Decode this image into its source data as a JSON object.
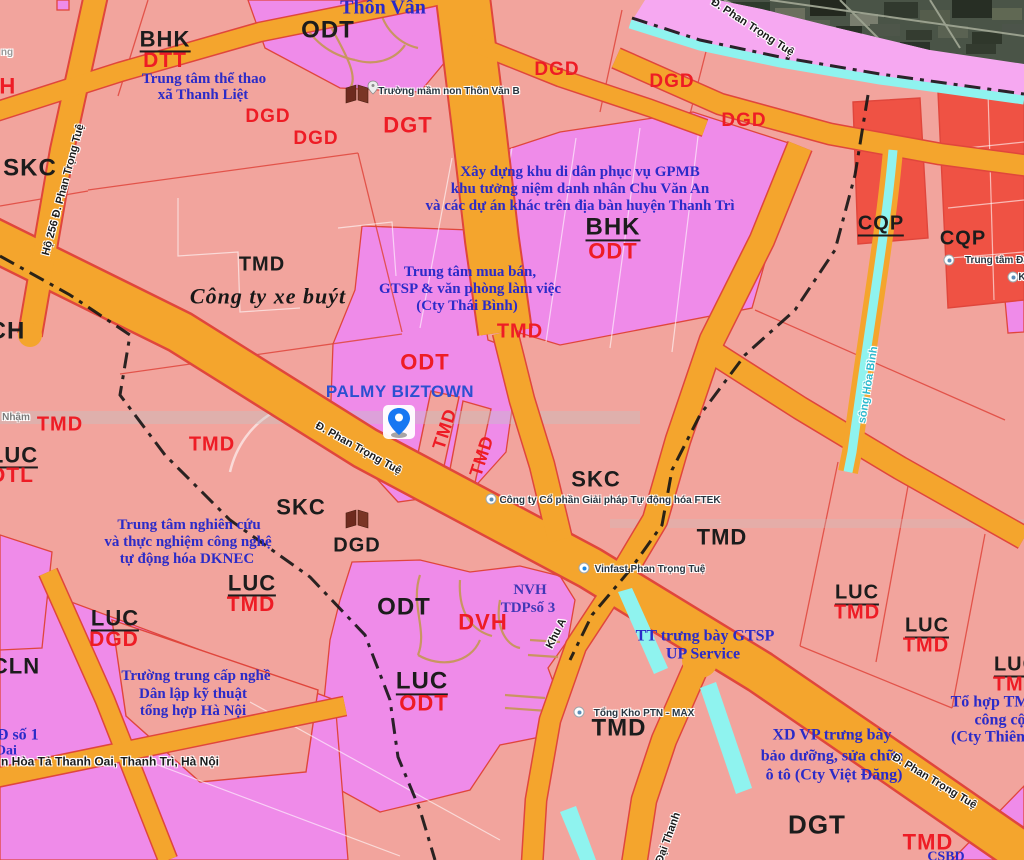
{
  "map": {
    "colors": {
      "salmon": "#F2A49D",
      "pink": "#EF8BE9",
      "pink-light": "#F6A8F1",
      "orange": "#F4A52D",
      "red-line": "#E0463C",
      "red-zone": "#EF5244",
      "cyan": "#8FF3EF",
      "label-red": "#EE1C25",
      "label-black": "#1C1C1C",
      "label-blue": "#2B2BC8",
      "palmy-blue": "#2B50D0",
      "nvh-blue": "#4038B6"
    },
    "zone_codes": [
      {
        "t": "BHK",
        "c": "black",
        "x": 165,
        "y": 40,
        "s": 22,
        "u": 1
      },
      {
        "t": "DTT",
        "c": "red",
        "x": 165,
        "y": 61,
        "s": 21
      },
      {
        "t": "ODT",
        "c": "black",
        "x": 328,
        "y": 30,
        "s": 24
      },
      {
        "t": "DGD",
        "c": "red",
        "x": 268,
        "y": 117,
        "s": 19
      },
      {
        "t": "DGD",
        "c": "red",
        "x": 316,
        "y": 139,
        "s": 19
      },
      {
        "t": "DGD",
        "c": "red",
        "x": 557,
        "y": 70,
        "s": 19
      },
      {
        "t": "DGD",
        "c": "red",
        "x": 672,
        "y": 82,
        "s": 19
      },
      {
        "t": "DGD",
        "c": "red",
        "x": 744,
        "y": 121,
        "s": 19
      },
      {
        "t": "DGT",
        "c": "red",
        "x": 408,
        "y": 125,
        "s": 22
      },
      {
        "t": "SKC",
        "c": "black",
        "x": 30,
        "y": 168,
        "s": 24
      },
      {
        "t": "VH",
        "c": "red",
        "x": 0,
        "y": 86,
        "s": 22
      },
      {
        "t": "CH",
        "c": "black",
        "x": 7,
        "y": 331,
        "s": 24
      },
      {
        "t": "BHK",
        "c": "black",
        "x": 613,
        "y": 228,
        "s": 24,
        "u": 1
      },
      {
        "t": "ODT",
        "c": "red",
        "x": 613,
        "y": 251,
        "s": 22
      },
      {
        "t": "TMD",
        "c": "red",
        "x": 520,
        "y": 332,
        "s": 20
      },
      {
        "t": "TMD",
        "c": "black",
        "x": 262,
        "y": 265,
        "s": 20
      },
      {
        "t": "ODT",
        "c": "red",
        "x": 425,
        "y": 362,
        "s": 22
      },
      {
        "t": "TMD",
        "c": "red",
        "x": 445,
        "y": 429,
        "s": 18,
        "rot": -72
      },
      {
        "t": "TMD",
        "c": "red",
        "x": 482,
        "y": 456,
        "s": 18,
        "rot": -72
      },
      {
        "t": "SKC",
        "c": "black",
        "x": 596,
        "y": 479,
        "s": 22
      },
      {
        "t": "TMD",
        "c": "black",
        "x": 722,
        "y": 537,
        "s": 22
      },
      {
        "t": "CQP",
        "c": "black",
        "x": 881,
        "y": 225,
        "s": 20,
        "u": 1
      },
      {
        "t": "CQP",
        "c": "black",
        "x": 963,
        "y": 239,
        "s": 20
      },
      {
        "t": "TMD",
        "c": "red",
        "x": 60,
        "y": 425,
        "s": 20
      },
      {
        "t": "TMD",
        "c": "red",
        "x": 212,
        "y": 445,
        "s": 20
      },
      {
        "t": "LUC",
        "c": "black",
        "x": 14,
        "y": 456,
        "s": 22,
        "u": 1
      },
      {
        "t": "DTL",
        "c": "red",
        "x": 12,
        "y": 476,
        "s": 21
      },
      {
        "t": "SKC",
        "c": "black",
        "x": 301,
        "y": 507,
        "s": 22
      },
      {
        "t": "DGD",
        "c": "black",
        "x": 357,
        "y": 546,
        "s": 20
      },
      {
        "t": "LUC",
        "c": "black",
        "x": 252,
        "y": 584,
        "s": 22,
        "u": 1
      },
      {
        "t": "TMD",
        "c": "red",
        "x": 251,
        "y": 605,
        "s": 21
      },
      {
        "t": "LUC",
        "c": "black",
        "x": 115,
        "y": 619,
        "s": 22,
        "u": 1
      },
      {
        "t": "DGD",
        "c": "red",
        "x": 114,
        "y": 640,
        "s": 21
      },
      {
        "t": "CLN",
        "c": "black",
        "x": 16,
        "y": 666,
        "s": 22
      },
      {
        "t": "ODT",
        "c": "black",
        "x": 404,
        "y": 607,
        "s": 24
      },
      {
        "t": "DVH",
        "c": "red",
        "x": 483,
        "y": 622,
        "s": 22
      },
      {
        "t": "LUC",
        "c": "black",
        "x": 422,
        "y": 682,
        "s": 24,
        "u": 1
      },
      {
        "t": "ODT",
        "c": "red",
        "x": 424,
        "y": 703,
        "s": 22
      },
      {
        "t": "TMD",
        "c": "black",
        "x": 619,
        "y": 728,
        "s": 24
      },
      {
        "t": "LUC",
        "c": "black",
        "x": 857,
        "y": 594,
        "s": 20,
        "u": 1
      },
      {
        "t": "TMD",
        "c": "red",
        "x": 857,
        "y": 613,
        "s": 20
      },
      {
        "t": "LUC",
        "c": "black",
        "x": 927,
        "y": 627,
        "s": 20,
        "u": 1
      },
      {
        "t": "TMD",
        "c": "red",
        "x": 926,
        "y": 646,
        "s": 20
      },
      {
        "t": "LUC",
        "c": "black",
        "x": 1016,
        "y": 666,
        "s": 20,
        "u": 1
      },
      {
        "t": "TMD",
        "c": "red",
        "x": 1016,
        "y": 685,
        "s": 20
      },
      {
        "t": "DGT",
        "c": "black",
        "x": 817,
        "y": 825,
        "s": 26
      },
      {
        "t": "TMD",
        "c": "red",
        "x": 928,
        "y": 842,
        "s": 22
      }
    ],
    "place_texts": [
      {
        "t": "Trung tâm thể thao",
        "x": 204,
        "y": 80
      },
      {
        "t": "xã Thanh Liệt",
        "x": 203,
        "y": 96
      },
      {
        "t": "Thôn Vân",
        "x": 383,
        "y": 8,
        "s": 20
      },
      {
        "t": "Xây dựng khu di dân phục vụ GPMB",
        "x": 580,
        "y": 173
      },
      {
        "t": "khu tưởng niệm danh nhân Chu Văn An",
        "x": 580,
        "y": 190
      },
      {
        "t": "và các dự án khác trên địa bàn huyện Thanh Trì",
        "x": 580,
        "y": 207
      },
      {
        "t": "Trung tâm mua bán,",
        "x": 470,
        "y": 273
      },
      {
        "t": "GTSP & văn phòng làm việc",
        "x": 470,
        "y": 290
      },
      {
        "t": "(Cty Thái Bình)",
        "x": 467,
        "y": 307
      },
      {
        "t": "Trung tâm nghiên cứu",
        "x": 189,
        "y": 526
      },
      {
        "t": "và thực nghiệm công nghệ",
        "x": 188,
        "y": 543
      },
      {
        "t": "tự động hóa DKNEC",
        "x": 187,
        "y": 560
      },
      {
        "t": "Trường trung cấp nghề",
        "x": 196,
        "y": 677
      },
      {
        "t": "Dân lập kỹ thuật",
        "x": 193,
        "y": 695
      },
      {
        "t": "tổng hợp Hà Nội",
        "x": 193,
        "y": 712
      },
      {
        "t": "TT trưng bày GTSP",
        "x": 705,
        "y": 637,
        "s": 16
      },
      {
        "t": "UP Service",
        "x": 703,
        "y": 655,
        "s": 16
      },
      {
        "t": "XD VP trưng bày",
        "x": 832,
        "y": 736,
        "s": 16
      },
      {
        "t": "bảo dưỡng, sửa chữa",
        "x": 832,
        "y": 757,
        "s": 16
      },
      {
        "t": "ô tô (Cty Việt Đăng)",
        "x": 834,
        "y": 776,
        "s": 16
      },
      {
        "t": "Tổ hợp TM",
        "x": 990,
        "y": 703,
        "s": 16
      },
      {
        "t": "công cộ",
        "x": 1000,
        "y": 721,
        "s": 16
      },
      {
        "t": "(Cty Thiên",
        "x": 988,
        "y": 738,
        "s": 16
      },
      {
        "t": "NVH",
        "x": 530,
        "y": 591,
        "c": "#4038B6"
      },
      {
        "t": "TDPsố 3",
        "x": 528,
        "y": 609,
        "c": "#4038B6"
      },
      {
        "t": "ĐĐ số 1",
        "x": 12,
        "y": 736,
        "s": 16
      },
      {
        "t": "Oai",
        "x": 6,
        "y": 752,
        "s": 14
      },
      {
        "t": "CSBD",
        "x": 946,
        "y": 858,
        "s": 14
      }
    ],
    "company_label": {
      "t": "Công ty xe buýt",
      "x": 268,
      "y": 296
    },
    "palmy_label": {
      "t": "PALMY BIZTOWN",
      "x": 400,
      "y": 392
    },
    "road_labels": [
      {
        "t": "Đ. Phan Trọng Tuệ",
        "x": 358,
        "y": 449,
        "rot": 29
      },
      {
        "t": "Đ. Phan Trọng Tuệ",
        "x": 934,
        "y": 782,
        "rot": 31
      },
      {
        "t": "Đ. Phan Trọng Tuệ",
        "x": 752,
        "y": 28,
        "rot": 33
      },
      {
        "t": "Hộ 256 Đ. Phan Trọng Tuệ",
        "x": 64,
        "y": 190,
        "rot": -75
      },
      {
        "t": "Khu A",
        "x": 557,
        "y": 634,
        "rot": -63
      },
      {
        "t": "Đại Thanh",
        "x": 669,
        "y": 838,
        "rot": -70
      },
      {
        "t": "sông Hòa Bình",
        "x": 869,
        "y": 385,
        "rot": -81,
        "c": "#2FB9CE"
      },
      {
        "t": "Nhậm",
        "x": 16,
        "y": 418,
        "c": "#7a7a7a",
        "s": 10
      },
      {
        "t": "ng",
        "x": 7,
        "y": 53,
        "c": "#9a9a9a",
        "s": 10
      },
      {
        "t": "n Hòa Tả Thanh Oai, Thanh Trì, Hà Nội",
        "x": 110,
        "y": 762,
        "s": 12
      }
    ],
    "pois": [
      {
        "t": "Trường mầm non Thôn Văn B",
        "lx": 449,
        "ly": 92
      },
      {
        "t": "Công ty Cổ phần Giải pháp Tự động hóa FTEK",
        "lx": 610,
        "ly": 501,
        "dx": 491,
        "dy": 499
      },
      {
        "t": "Vinfast Phan Trọng Tuệ",
        "lx": 650,
        "ly": 570,
        "dx": 584,
        "dy": 568,
        "blue": 1
      },
      {
        "t": "Tổng Kho PTN - MAX",
        "lx": 644,
        "ly": 714,
        "dx": 579,
        "dy": 712
      },
      {
        "t": "Trung tâm Đào",
        "lx": 1000,
        "ly": 261,
        "dx": 949,
        "dy": 260
      },
      {
        "t": "K",
        "lx": 1022,
        "ly": 278,
        "dx": 1013,
        "dy": 277
      }
    ]
  }
}
